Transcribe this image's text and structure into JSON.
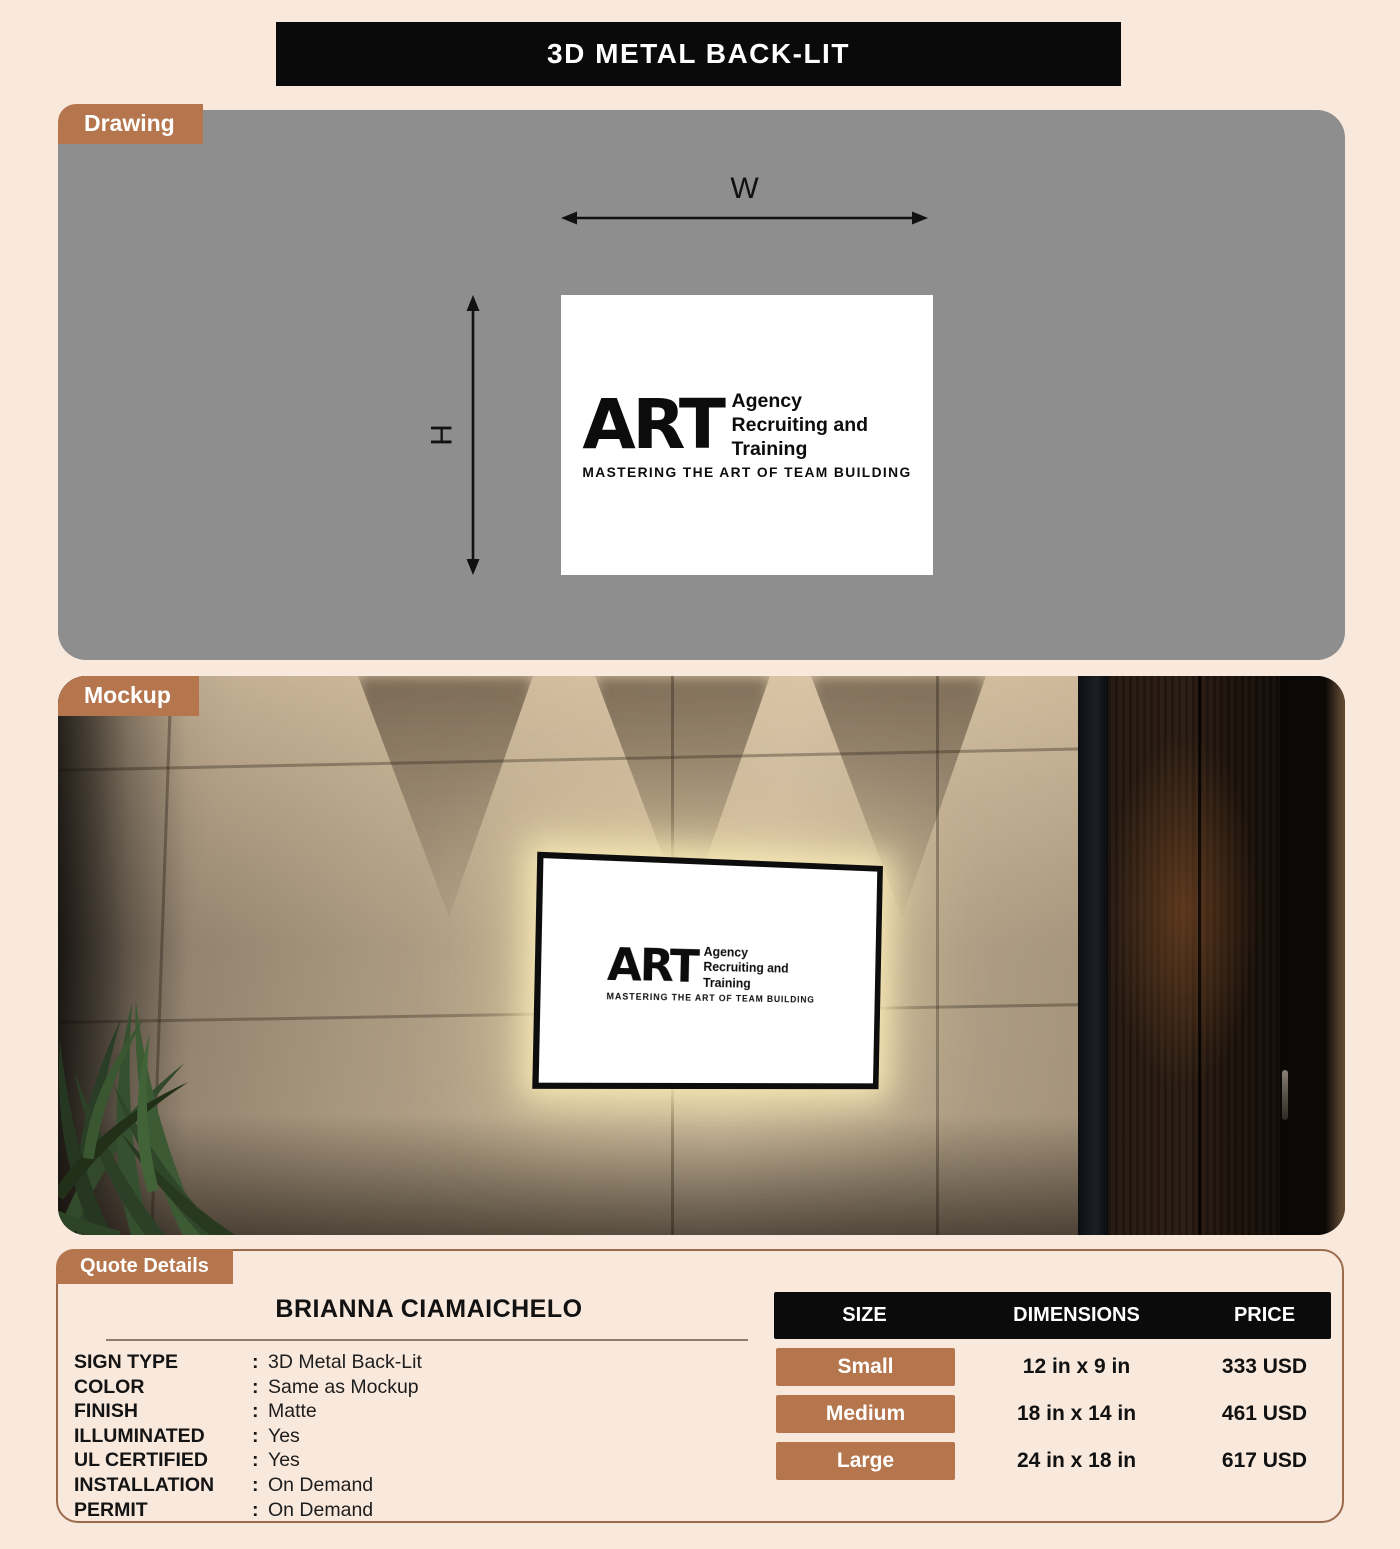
{
  "page": {
    "title": "3D METAL BACK-LIT"
  },
  "sections": {
    "drawing": {
      "label": "Drawing",
      "width_label": "W",
      "height_label": "H"
    },
    "mockup": {
      "label": "Mockup"
    },
    "quote": {
      "label": "Quote Details"
    }
  },
  "logo": {
    "acronym": "ART",
    "name_lines": [
      "Agency",
      "Recruiting and",
      "Training"
    ],
    "tagline": "MASTERING THE ART OF TEAM BUILDING"
  },
  "quote": {
    "customer_name": "BRIANNA CIAMAICHELO",
    "separator": ":",
    "fields": [
      {
        "label": "SIGN TYPE",
        "value": "3D Metal Back-Lit"
      },
      {
        "label": "COLOR",
        "value": "Same as Mockup"
      },
      {
        "label": "FINISH",
        "value": "Matte"
      },
      {
        "label": "ILLUMINATED",
        "value": "Yes"
      },
      {
        "label": "UL CERTIFIED",
        "value": "Yes"
      },
      {
        "label": "INSTALLATION",
        "value": "On Demand"
      },
      {
        "label": "PERMIT",
        "value": "On Demand"
      }
    ],
    "pricing_table": {
      "headers": [
        "SIZE",
        "DIMENSIONS",
        "PRICE"
      ],
      "rows": [
        {
          "size": "Small",
          "dimensions": "12 in x 9 in",
          "price": "333 USD"
        },
        {
          "size": "Medium",
          "dimensions": "18 in x 14 in",
          "price": "461 USD"
        },
        {
          "size": "Large",
          "dimensions": "24 in x 18 in",
          "price": "617 USD"
        }
      ]
    }
  },
  "colors": {
    "accent_brown": "#b5764e",
    "page_background": "#f9e8dc",
    "drawing_gray": "#8e8e8e",
    "header_black": "#0b0b0b"
  }
}
